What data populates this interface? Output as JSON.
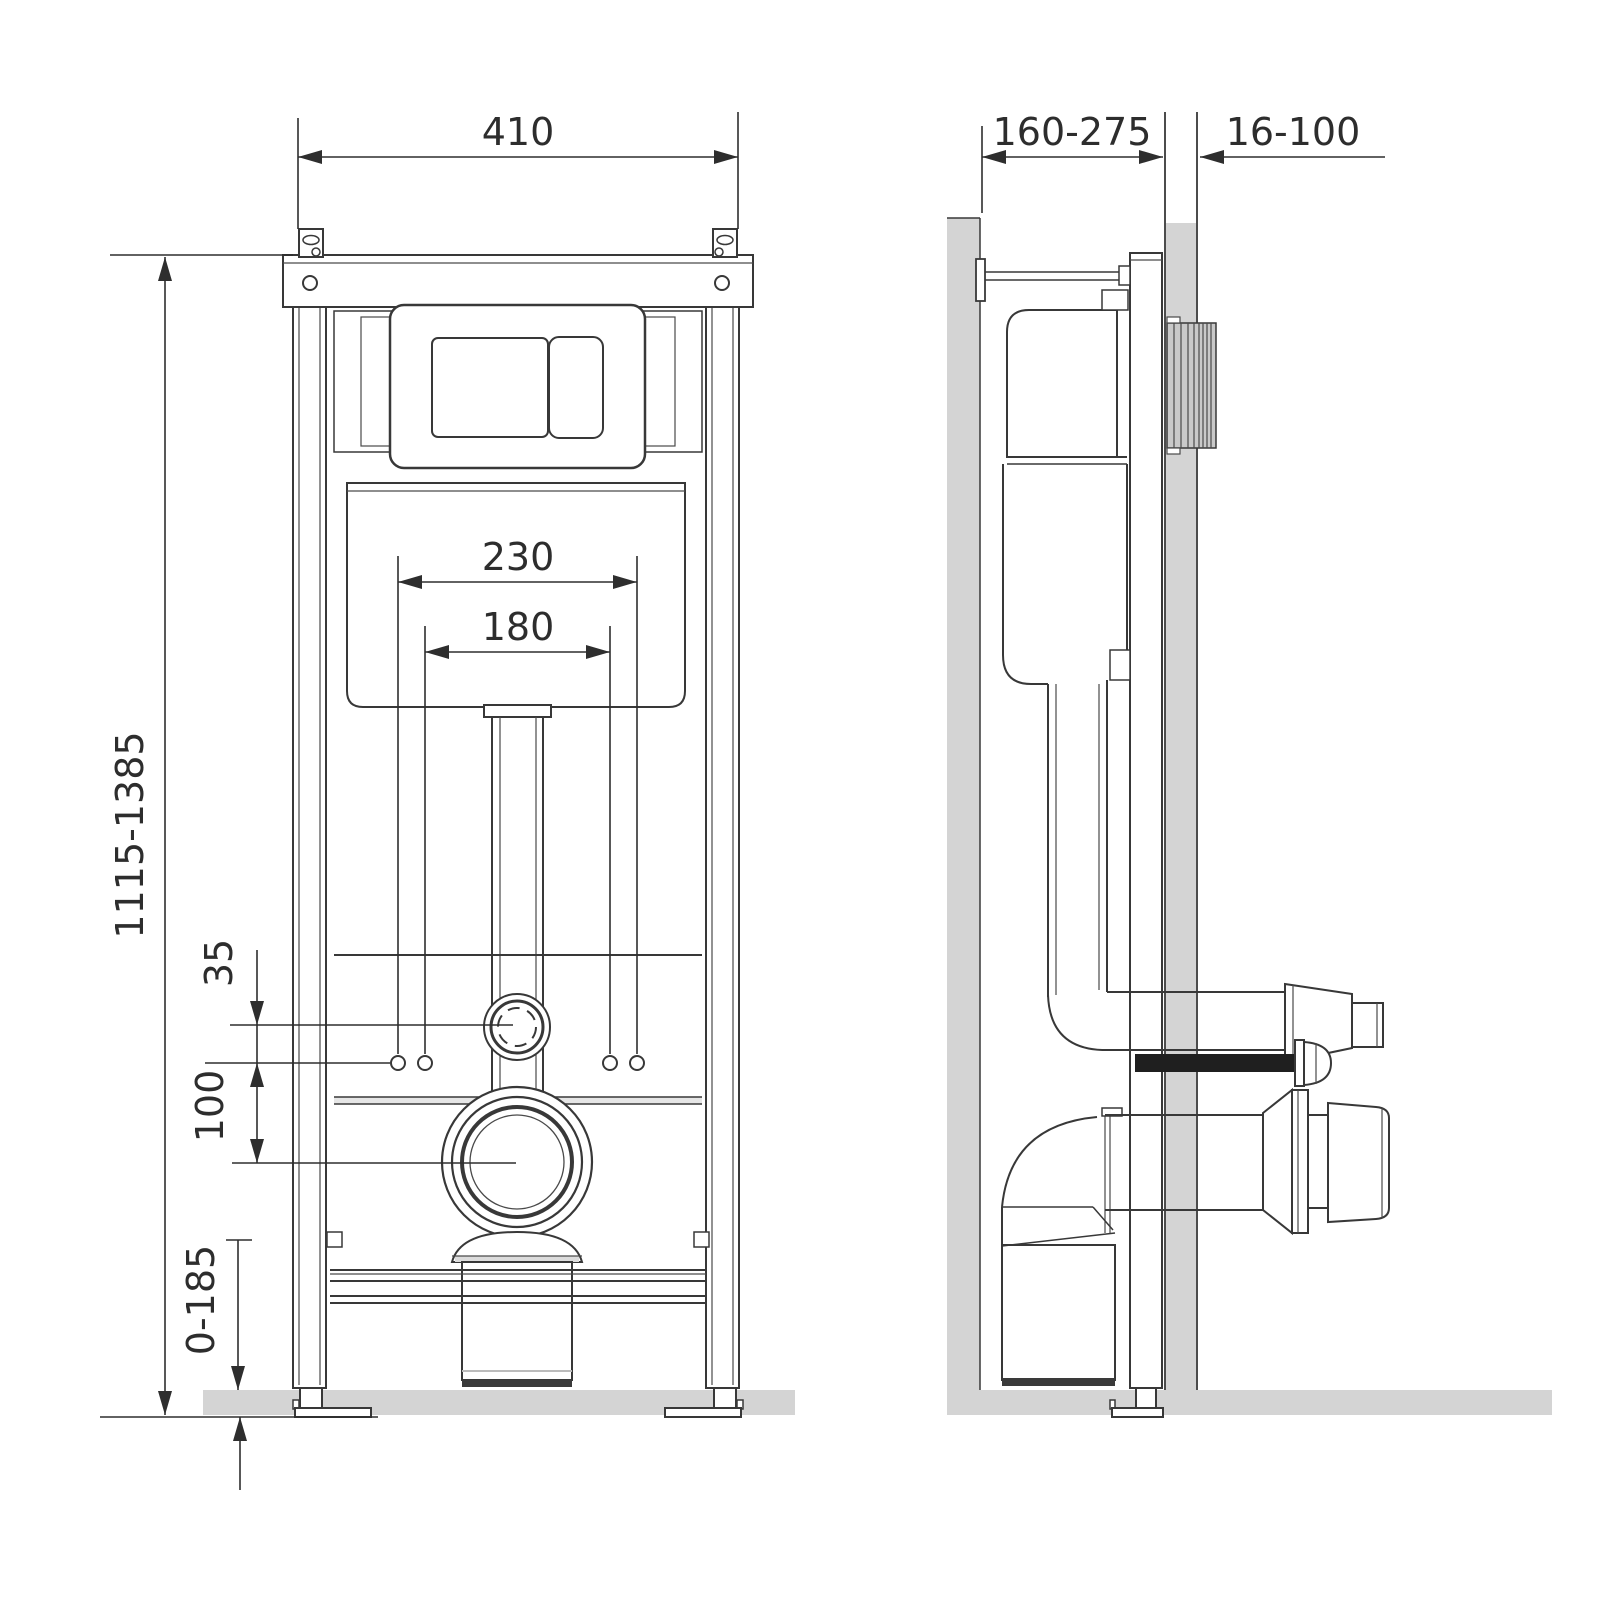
{
  "dimensions": {
    "frame_width": "410",
    "frame_height_range": "1115-1385",
    "stud_spacing_outer": "230",
    "stud_spacing_inner": "180",
    "inlet_to_studs_offset": "35",
    "studs_to_drain_offset": "100",
    "leg_adjustment_range": "0-185",
    "install_depth_range": "160-275",
    "wall_finish_range": "16-100"
  },
  "colors": {
    "line": "#383838",
    "dimension": "#2e2e2e",
    "masonry_gray": "#d4d4d4",
    "dark_fill": "#2a2a2a"
  }
}
